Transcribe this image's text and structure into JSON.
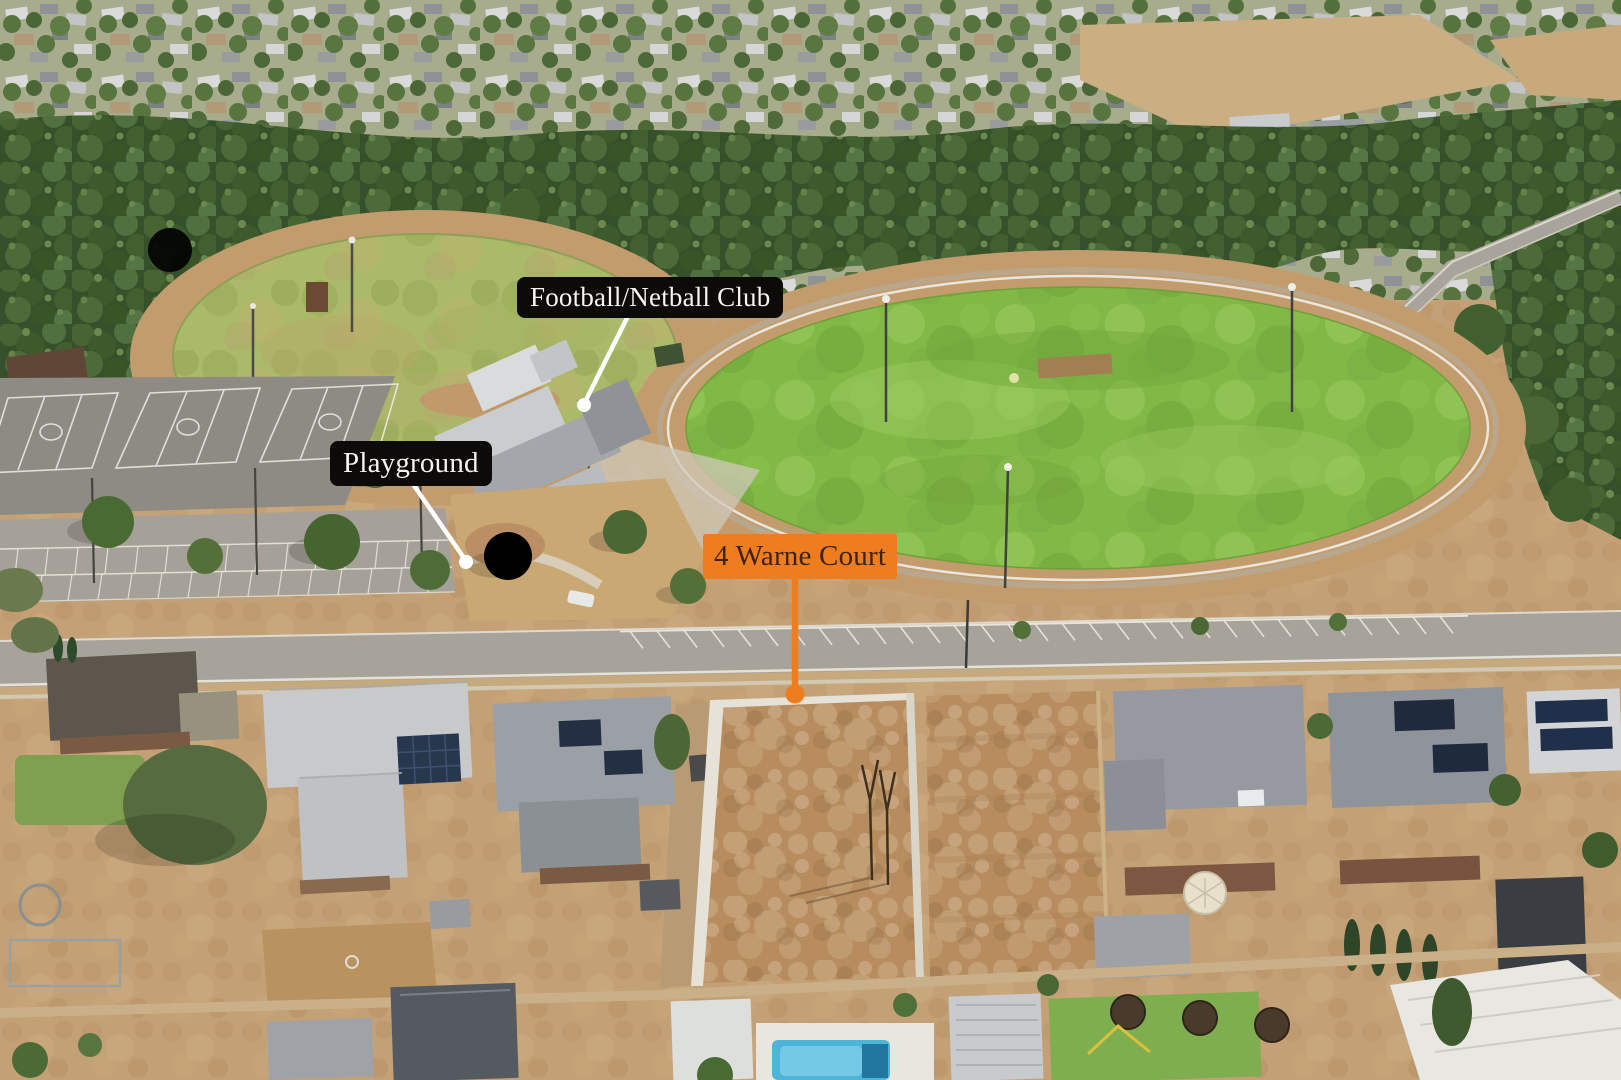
{
  "photo": {
    "kind": "annotated aerial drone photo",
    "subject": "vacant residential land opposite sports reserve"
  },
  "palette": {
    "accent_orange": "#EE7D1F",
    "label_black": "#0D0B09",
    "label_text_light": "#F6F4F0",
    "label_text_dark": "#3F2309",
    "leader_white": "#FFFFFF"
  },
  "labels": {
    "property": {
      "text": "4 Warne Court"
    },
    "club": {
      "text": "Football/Netball Club"
    },
    "playground": {
      "text": "Playground"
    }
  }
}
